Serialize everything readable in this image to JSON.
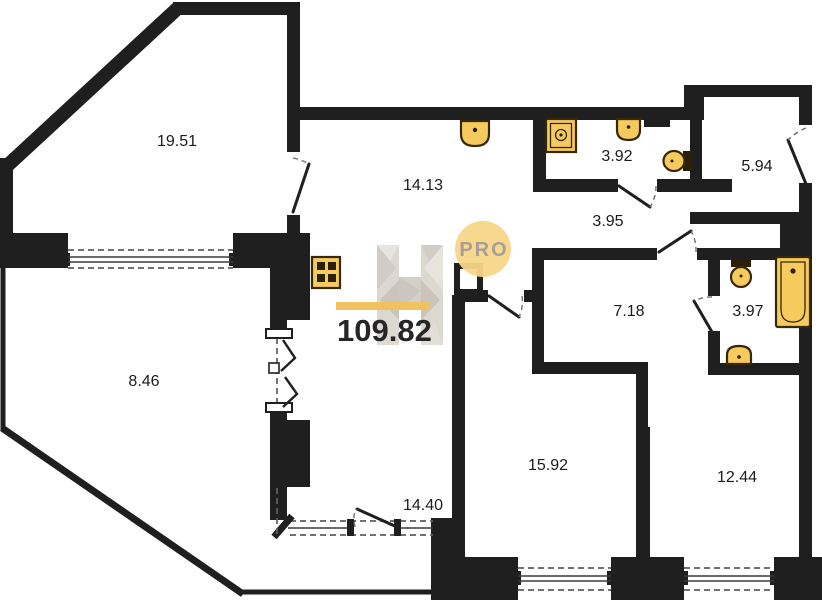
{
  "plan_title": "apartment-floor-plan",
  "total_area": {
    "value": "109.82"
  },
  "badge": {
    "label": "PRO"
  },
  "rooms": [
    {
      "name": "living-room",
      "area_label": "19.51"
    },
    {
      "name": "kitchen",
      "area_label": "14.13"
    },
    {
      "name": "bathroom",
      "area_label": "3.92"
    },
    {
      "name": "hallway",
      "area_label": "3.95"
    },
    {
      "name": "entrance-hall",
      "area_label": "5.94"
    },
    {
      "name": "corridor",
      "area_label": "7.18"
    },
    {
      "name": "wc",
      "area_label": "3.97"
    },
    {
      "name": "terrace",
      "area_label": "8.46"
    },
    {
      "name": "bedroom",
      "area_label": "15.92"
    },
    {
      "name": "bedroom-2",
      "area_label": "12.44"
    },
    {
      "name": "balcony",
      "area_label": "14.40"
    }
  ],
  "fixtures": [
    "stove",
    "kitchen-sink",
    "washing-machine",
    "sink",
    "toilet",
    "toilet",
    "bathtub",
    "sink"
  ],
  "colors": {
    "wall": "#1f1f1f",
    "fixture_fill": "#f7ca5e",
    "fixture_stroke": "#352805",
    "accent_gold": "#eebd53",
    "badge_fill": "#f8d689",
    "badge_text": "#a29a90",
    "logo_gray": "#d9d4ce",
    "label_text": "#1b1b1b"
  }
}
